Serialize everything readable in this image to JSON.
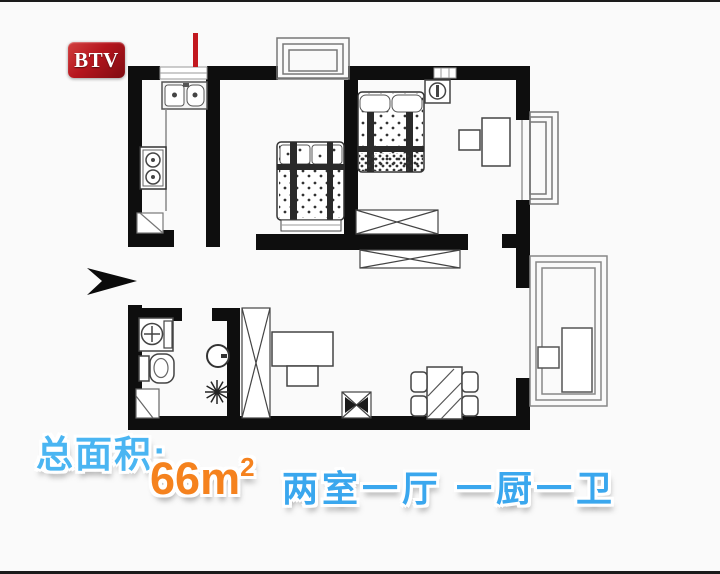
{
  "logo": {
    "text": "BTV"
  },
  "caption": {
    "area_label": "总面积:",
    "area_value": "66",
    "area_unit": "m",
    "area_sup": "2",
    "rooms_text": "两室一厅 一厨一卫",
    "colors": {
      "area_label": "#4ab5f2",
      "area_value": "#f5821e",
      "rooms_text": "#3aa7ee"
    }
  },
  "floor_plan": {
    "colors": {
      "walls": "#0e0e0e",
      "furniture_line": "#444444",
      "window_line": "#8a8a8a",
      "marker": "#c2181f"
    },
    "entrance_arrow_direction": "right",
    "symbols": [
      "entrance-arrow",
      "annotation-marker",
      "double-sink",
      "gas-stove",
      "kitchen-counter",
      "double-bed",
      "double-bed",
      "nightstand-lamp",
      "desk",
      "chair",
      "wardrobe",
      "sideboard",
      "tall-wardrobe",
      "tv-cabinet",
      "tv",
      "coffee-stool",
      "dining-table",
      "dining-chair",
      "washbasin",
      "toilet",
      "shower-tray",
      "floor-drain",
      "wall-mirror",
      "bay-window",
      "bay-window",
      "balcony",
      "balcony-desk",
      "balcony-chair"
    ]
  }
}
